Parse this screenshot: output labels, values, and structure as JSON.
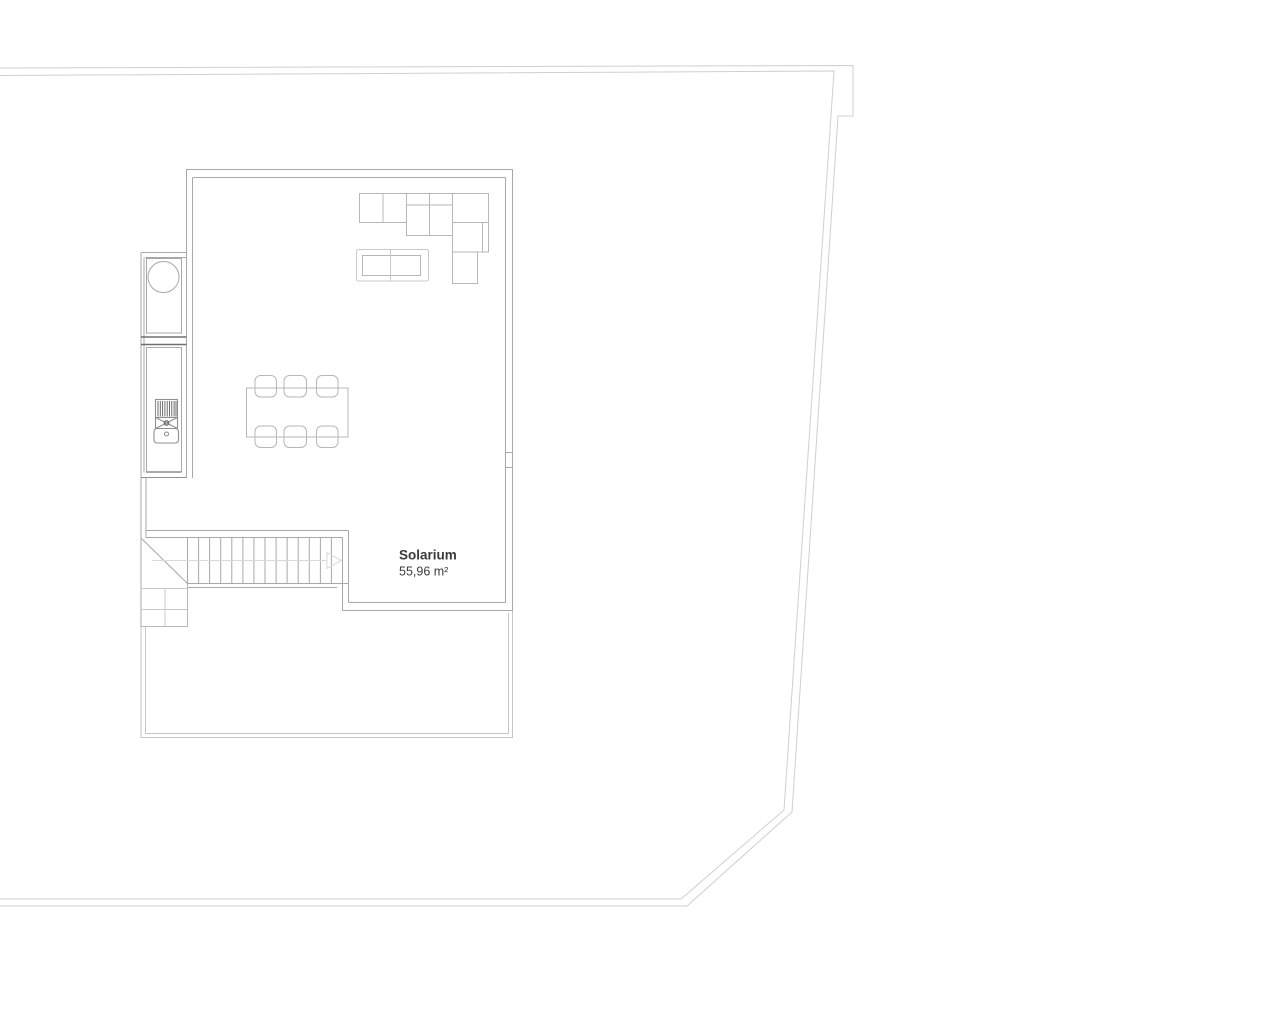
{
  "floor_plan": {
    "room_label": {
      "name": "Solarium",
      "area": "55,96 m²"
    }
  },
  "colors": {
    "background": "#ffffff",
    "plot": "#cfcfcf",
    "wall": "#a8a8a8",
    "wall_dark": "#6e6e6e",
    "furniture": "#b7b7b7",
    "furniture_light": "#c9c9c9",
    "stairs": "#a8a8a8",
    "guide": "#d9d9d9",
    "terrace": "#c6c6c6",
    "text": "#3b3b3b"
  }
}
